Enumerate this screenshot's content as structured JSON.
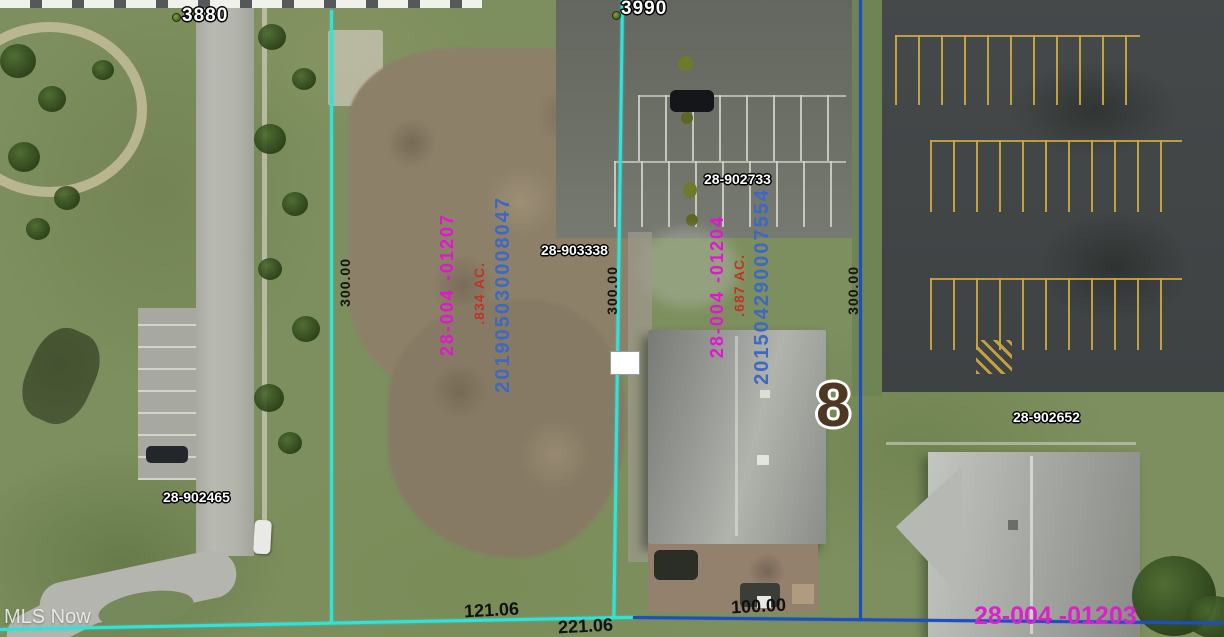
{
  "map": {
    "watermark": "MLS Now",
    "badge_label": "8"
  },
  "markers": {
    "house_number_left": "3880",
    "house_number_top": "3990"
  },
  "parcel_tags": {
    "tag_28_902733": "28-902733",
    "tag_28_903338": "28-903338",
    "tag_28_902465": "28-902465",
    "tag_28_902652": "28-902652"
  },
  "parcels": {
    "left": {
      "id": "28-004 -01207",
      "acreage": ".834 AC.",
      "instrument": "201905030008047"
    },
    "middle": {
      "id": "28-004 -01204",
      "acreage": ".687 AC.",
      "instrument": "201504290007554"
    },
    "bottom_right": {
      "id": "28-004 -01203"
    }
  },
  "dimensions": {
    "left_side": "300.00",
    "middle_side": "300.00",
    "right_side": "300.00",
    "bottom_121": "121.06",
    "bottom_221": "221.06",
    "bottom_100": "100.00"
  },
  "colors": {
    "boundary_cyan": "#2fe3da",
    "boundary_blue": "#1c4fc0",
    "parcel_id_magenta": "#e315d2",
    "acreage_red": "#c23327",
    "instrument_blue": "#3d68c4",
    "badge_brown": "#4e3823"
  }
}
